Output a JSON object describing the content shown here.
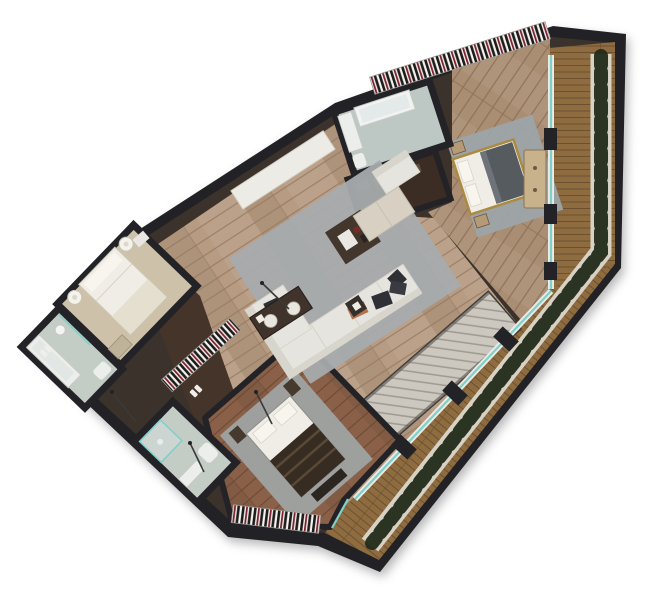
{
  "scene": {
    "kind": "apartment-floor-plan-render",
    "view": "top-down",
    "rooms": [
      "living-room",
      "master-bedroom",
      "en-suite-bathroom",
      "walk-in-wardrobe",
      "bedroom-2",
      "bedroom-3",
      "bathroom-1",
      "bathroom-2",
      "hallway",
      "staircase",
      "wrap-around-balcony"
    ],
    "furniture": [
      "sectional-sofa",
      "coffee-table",
      "tv-console",
      "ottoman",
      "armchair",
      "area-rug",
      "double-bed",
      "single-bed",
      "nightstand",
      "dresser",
      "bathtub",
      "shower",
      "toilet",
      "vanity-sink",
      "radiator-strip",
      "balcony-planters",
      "sideboard",
      "floor-lamp"
    ]
  },
  "colors": {
    "canvas": "#ffffff",
    "wall": "#232327",
    "wallInner": "#3b322b",
    "woodLiving": "#b79b82",
    "woodLivingLine": "#9a7f66",
    "woodMaster": "#aa8e73",
    "woodMasterLine": "#8e7259",
    "woodBr3": "#8a6148",
    "woodBr3Line": "#6e4b37",
    "woodHall": "#45342a",
    "closetFloor": "#3b2c24",
    "deck": "#8e6c40",
    "deckLine": "#6b5130",
    "gravel": "#d8d2c4",
    "plant": "#232c1c",
    "glass": "#7fd0c8",
    "frame": "#eceae6",
    "rugLiving": "#a6abad",
    "rugMaster": "#9da4a8",
    "rugBr3": "#9fa3a3",
    "sofa": "#e6e4de",
    "sofaShade": "#d8d5cc",
    "tableDark": "#43362c",
    "consoleDark": "#3f332b",
    "ottoman": "#d8d1c3",
    "bath": "#bdc7c3",
    "bathLeft": "#c4ccc6",
    "fixture": "#eceeeb",
    "bedWhite": "#efede6",
    "pillow": "#f7f5ee",
    "blanketGray": "#565b60",
    "blanketBrown": "#372c22",
    "gold": "#ab8a42",
    "dresser": "#c7b28c",
    "nightstand": "#b59a76",
    "nightstandDark": "#463a2e",
    "stair": "#ccc8c0",
    "stairLine": "#a19c93",
    "radiatorBg": "#f4f2ec",
    "radiatorDark": "#1c1c1c",
    "radiatorRed": "#7c2130",
    "leftRoom": "#cdc2a9",
    "accentOrange": "#b3714e",
    "pillowDark": "#2f3036",
    "doorWhite": "#e9e7e3",
    "needle": "#3a3a3a"
  }
}
